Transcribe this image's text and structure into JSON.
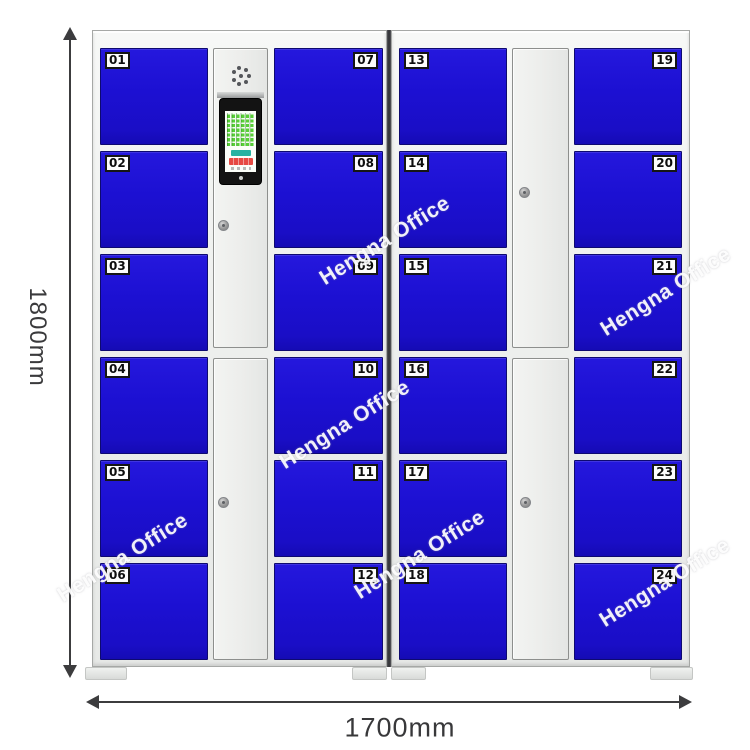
{
  "watermark": {
    "text": "Hengna Office"
  },
  "dimensions": {
    "height": "1800mm",
    "width": "1700mm"
  },
  "locker": {
    "door_color": "#1c10d2",
    "left_cabinet": {
      "left_column_doors": [
        "01",
        "02",
        "03",
        "04",
        "05",
        "06"
      ],
      "right_column_doors": [
        "07",
        "08",
        "09",
        "10",
        "11",
        "12"
      ],
      "center_column": {
        "components": [
          "speaker-grille",
          "touchscreen",
          "cam-lock",
          "cam-lock"
        ],
        "screen": {
          "keypad_grid_color": "#57cf36",
          "confirm_button_color": "#27b2a2",
          "cancel_button_color": "#e64a43"
        }
      }
    },
    "right_cabinet": {
      "left_column_doors": [
        "13",
        "14",
        "15",
        "16",
        "17",
        "18"
      ],
      "right_column_doors": [
        "19",
        "20",
        "21",
        "22",
        "23",
        "24"
      ],
      "center_column": {
        "components": [
          "cam-lock",
          "cam-lock"
        ]
      }
    }
  }
}
